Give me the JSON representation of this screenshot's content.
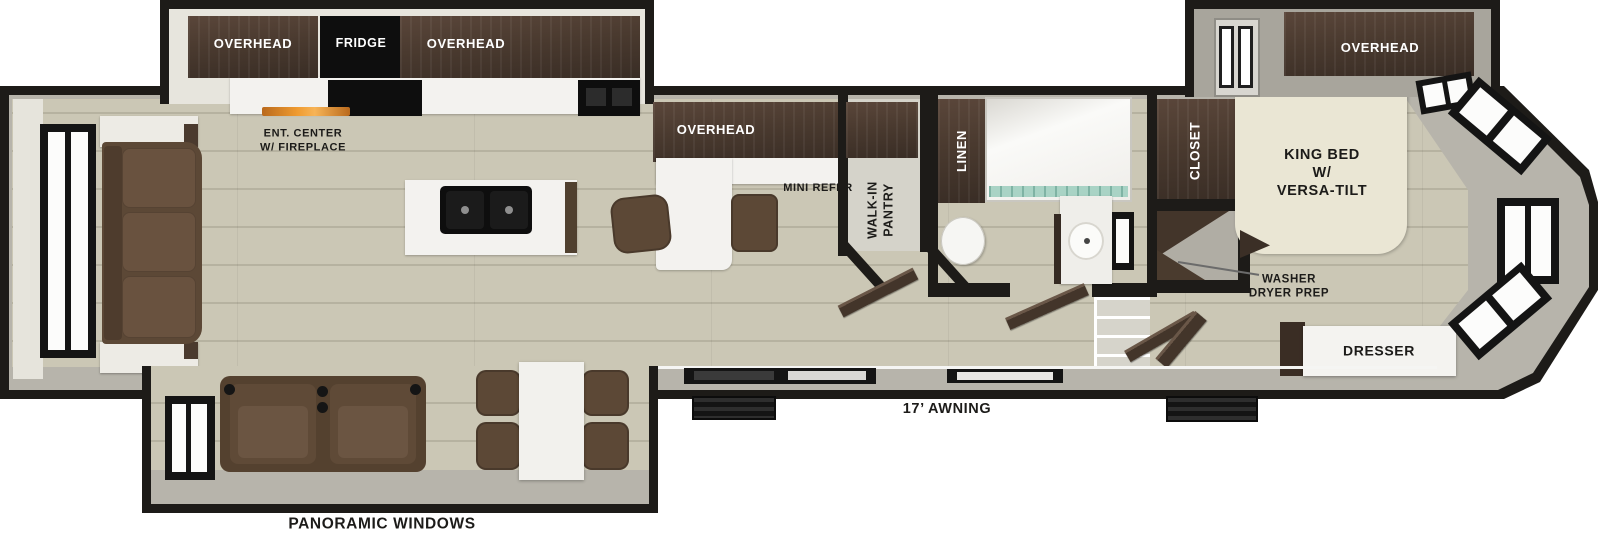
{
  "colors": {
    "wall": "#1d1b18",
    "floor": "#cbc7b5",
    "cabinet": "#4a3a2f",
    "appliance": "#0e0e0e",
    "counter": "#f3f2ef",
    "sofa": "#5c4836",
    "bed": "#eae6d4",
    "slideband": "#b7b4ab",
    "slidegrey": "#a8a59c",
    "glow": "#ef9b30",
    "glass": "#a9d3c5"
  },
  "kitchen": {
    "overhead_left_label": "OVERHEAD",
    "fridge_label": "FRIDGE",
    "overhead_right_label": "OVERHEAD",
    "ent_center_line1": "ENT. CENTER",
    "ent_center_line2": "W/ FIREPLACE",
    "peninsula_overhead_label": "OVERHEAD",
    "mini_refer_label": "MINI REFER"
  },
  "pantry": {
    "label_line1": "WALK-IN",
    "label_line2": "PANTRY"
  },
  "bathroom": {
    "linen_label": "LINEN"
  },
  "bedroom": {
    "closet_label": "CLOSET",
    "overhead_label": "OVERHEAD",
    "bed_line1": "KING BED",
    "bed_line2": "W/",
    "bed_line3": "VERSA-TILT",
    "washer_line1": "WASHER",
    "washer_line2": "DRYER PREP",
    "dresser_label": "DRESSER"
  },
  "exterior": {
    "awning_label": "17’ AWNING",
    "panoramic_label": "PANORAMIC WINDOWS"
  }
}
